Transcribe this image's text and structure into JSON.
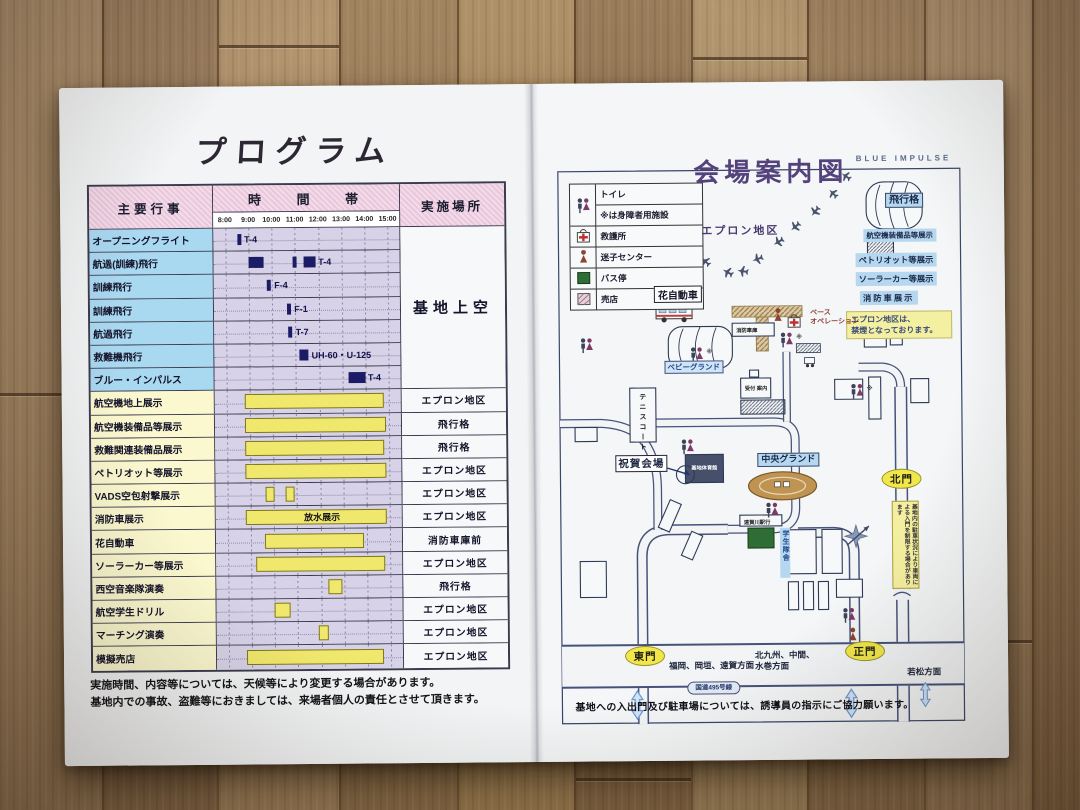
{
  "colors": {
    "gate_yellow": "#f1e74b",
    "label_blue": "#b5d7f0",
    "bar_yellow": "#f0e76d",
    "bar_navy": "#1c1c66",
    "note_yellow": "#f4f0a2",
    "title_purple": "#53427c"
  },
  "left_page": {
    "title": "プログラム",
    "table": {
      "col_event": "主要行事",
      "col_time": "時 間 帯",
      "col_place": "実施場所",
      "times": [
        "8:00",
        "9:00",
        "10:00",
        "11:00",
        "12:00",
        "13:00",
        "14:00",
        "15:00"
      ],
      "sky_place": "基地上空",
      "rows": [
        {
          "name": "オープニングフライト",
          "place": "",
          "bars": [
            {
              "t": "tick",
              "s": 8.55,
              "e": 8.72
            }
          ],
          "labels": [
            {
              "x": 8.82,
              "text": "T-4"
            }
          ]
        },
        {
          "name": "航過(訓練)飛行",
          "place": "",
          "bars": [
            {
              "t": "navy",
              "s": 9.0,
              "e": 9.65
            },
            {
              "t": "tick",
              "s": 10.9,
              "e": 11.05
            },
            {
              "t": "navy",
              "s": 11.35,
              "e": 11.9
            }
          ],
          "labels": [
            {
              "x": 12.0,
              "text": "T-4"
            }
          ]
        },
        {
          "name": "訓練飛行",
          "place": "",
          "bars": [
            {
              "t": "tick",
              "s": 9.8,
              "e": 9.95
            }
          ],
          "labels": [
            {
              "x": 10.1,
              "text": "F-4"
            }
          ]
        },
        {
          "name": "訓練飛行",
          "place": "",
          "bars": [
            {
              "t": "tick",
              "s": 10.65,
              "e": 10.8
            }
          ],
          "labels": [
            {
              "x": 10.95,
              "text": "F-1"
            }
          ]
        },
        {
          "name": "航過飛行",
          "place": "",
          "bars": [
            {
              "t": "tick",
              "s": 10.7,
              "e": 10.85
            }
          ],
          "labels": [
            {
              "x": 11.0,
              "text": "T-7"
            }
          ]
        },
        {
          "name": "救難機飛行",
          "place": "",
          "bars": [
            {
              "t": "navy",
              "s": 11.15,
              "e": 11.55
            }
          ],
          "labels": [
            {
              "x": 11.68,
              "text": "UH-60・U-125"
            }
          ]
        },
        {
          "name": "ブルー・インパルス",
          "place": "",
          "bars": [
            {
              "t": "navy",
              "s": 13.25,
              "e": 14.0
            }
          ],
          "labels": [
            {
              "x": 14.1,
              "text": "T-4"
            }
          ]
        },
        {
          "name": "航空機地上展示",
          "place": "エプロン地区",
          "bars": [
            {
              "t": "yellow",
              "s": 8.8,
              "e": 14.7
            }
          ]
        },
        {
          "name": "航空機装備品等展示",
          "place": "飛行格",
          "bars": [
            {
              "t": "yellow",
              "s": 8.8,
              "e": 14.75
            }
          ]
        },
        {
          "name": "救難関連装備品展示",
          "place": "飛行格",
          "bars": [
            {
              "t": "yellow",
              "s": 8.8,
              "e": 14.7
            }
          ]
        },
        {
          "name": "ペトリオット等展示",
          "place": "エプロン地区",
          "bars": [
            {
              "t": "yellow",
              "s": 8.8,
              "e": 14.75
            }
          ]
        },
        {
          "name": "VADS空包射撃展示",
          "place": "エプロン地区",
          "bars": [
            {
              "t": "yellow",
              "s": 9.65,
              "e": 9.95
            },
            {
              "t": "yellow",
              "s": 10.5,
              "e": 10.8
            }
          ]
        },
        {
          "name": "消防車展示",
          "place": "エプロン地区",
          "bars": [
            {
              "t": "yellow",
              "s": 8.8,
              "e": 14.75
            }
          ],
          "labels": [
            {
              "x": 11.3,
              "text": "放水展示",
              "on": true
            }
          ]
        },
        {
          "name": "花自動車",
          "place": "消防車庫前",
          "bars": [
            {
              "t": "yellow",
              "s": 9.6,
              "e": 13.8
            }
          ]
        },
        {
          "name": "ソーラーカー等展示",
          "place": "エプロン地区",
          "bars": [
            {
              "t": "yellow",
              "s": 9.2,
              "e": 14.7
            }
          ]
        },
        {
          "name": "西空音楽隊演奏",
          "place": "飛行格",
          "bars": [
            {
              "t": "yellow",
              "s": 12.3,
              "e": 12.85
            }
          ]
        },
        {
          "name": "航空学生ドリル",
          "place": "エプロン地区",
          "bars": [
            {
              "t": "yellow",
              "s": 10.0,
              "e": 10.6
            }
          ]
        },
        {
          "name": "マーチング演奏",
          "place": "エプロン地区",
          "bars": [
            {
              "t": "yellow",
              "s": 11.9,
              "e": 12.25
            }
          ]
        },
        {
          "name": "模擬売店",
          "place": "エプロン地区",
          "bars": [
            {
              "t": "yellow",
              "s": 8.8,
              "e": 14.6
            }
          ]
        }
      ]
    },
    "notes": [
      "実施時間、内容等については、天候等により変更する場合があります。",
      "基地内での事故、盗難等におきましては、来場者個人の責任とさせて頂きます。"
    ]
  },
  "right_page": {
    "corner": "BLUE  IMPULSE",
    "title": "会場案内図",
    "legend": {
      "toilet": "トイレ",
      "toilet_note": "※は身障者用施設",
      "aid": "救護所",
      "lost_child": "迷子センター",
      "bus": "バス停",
      "shop": "売店"
    },
    "map": {
      "apron": "エプロン地区",
      "hangar": "飛行格",
      "equip": "航空機装備品等展示",
      "patriot": "ペトリオット等展示",
      "solar": "ソーラーカー等展示",
      "fire": "消防車展示",
      "no_smoking": "エプロン地区は、\n禁煙となっております。",
      "hana": "花自動車",
      "fire_garage": "消防車庫",
      "base_ops": "ベース\nオペレーション",
      "reception": "受付 案内",
      "baby_ground": "ベビーグランド",
      "tennis": "テニスコート",
      "celebration": "祝賀会場",
      "gym": "基地体育館",
      "central_ground": "中央グランド",
      "station_bus": "遠賀川駅行",
      "dorm": "学生隊舎",
      "north_gate": "北門",
      "east_gate": "東門",
      "main_gate": "正門",
      "dir_fukuoka": "福岡、岡垣、遠賀方面",
      "dir_kitakyushu": "北九州、中間、\n水巻方面",
      "dir_wakamatsu": "若松方面",
      "route": "国道495号線",
      "parking_note": "基地内の駐車状況により車両による入門を制限する場合があります",
      "wc_note": "※"
    },
    "bottom_note": "基地への入出門及び駐車場については、誘導員の指示にご協力願います。"
  }
}
